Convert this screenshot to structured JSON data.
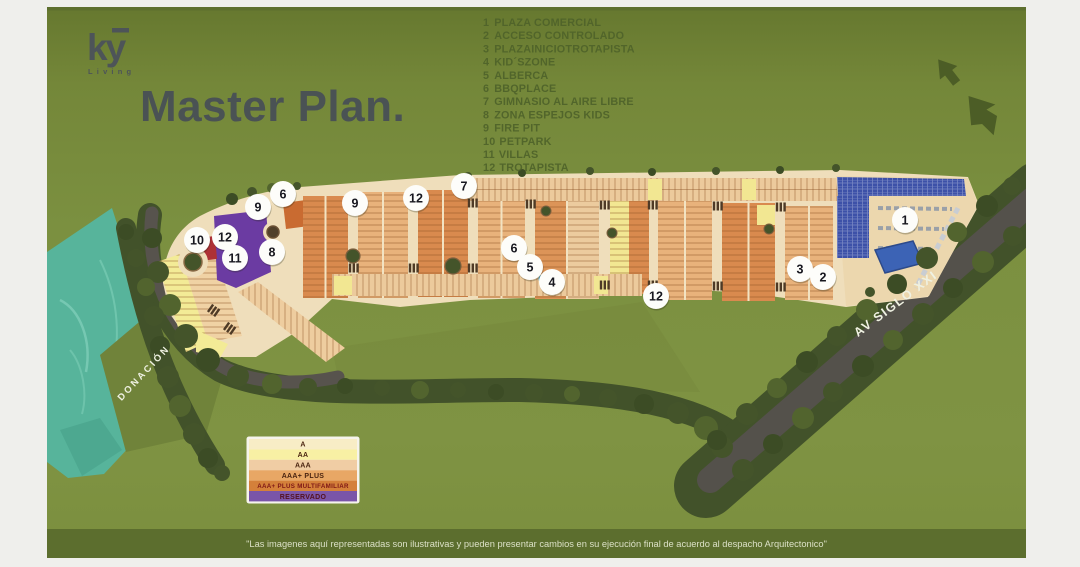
{
  "brand": {
    "name": "ky",
    "tagline": "Living"
  },
  "title": "Master Plan.",
  "amenities": {
    "items": [
      {
        "num": "1",
        "label": "PLAZA COMERCIAL"
      },
      {
        "num": "2",
        "label": "ACCESO CONTROLADO"
      },
      {
        "num": "3",
        "label": "PLAZAINICIOTROTAPISTA"
      },
      {
        "num": "4",
        "label": "KID´SZONE"
      },
      {
        "num": "5",
        "label": "ALBERCA"
      },
      {
        "num": "6",
        "label": "BBQPLACE"
      },
      {
        "num": "7",
        "label": "GIMNASIO AL AIRE LIBRE"
      },
      {
        "num": "8",
        "label": "ZONA ESPEJOS KIDS"
      },
      {
        "num": "9",
        "label": "FIRE PIT"
      },
      {
        "num": "10",
        "label": "PETPARK"
      },
      {
        "num": "11",
        "label": "VILLAS"
      },
      {
        "num": "12",
        "label": "TROTAPISTA"
      }
    ]
  },
  "map": {
    "road_label": "AV SIGLO XXI",
    "area_label": "DONACIÓN",
    "markers": [
      "9",
      "6",
      "10",
      "12",
      "11",
      "8",
      "9",
      "12",
      "7",
      "6",
      "5",
      "4",
      "12",
      "3",
      "2",
      "1"
    ]
  },
  "lot_legend": {
    "rows": [
      {
        "label": "A",
        "color": "#f8edc6",
        "text_color": "#4a2410"
      },
      {
        "label": "AA",
        "color": "#f8f0a4",
        "text_color": "#4a2410"
      },
      {
        "label": "AAA",
        "color": "#f0cda4",
        "text_color": "#4a2410"
      },
      {
        "label": "AAA+ PLUS",
        "color": "#e8a765",
        "text_color": "#4a2410"
      },
      {
        "label": "AAA+ PLUS MULTIFAMILIAR",
        "color": "#d4803a",
        "text_color": "#7e1616"
      },
      {
        "label": "RESERVADO",
        "color": "#7a55a8",
        "text_color": "#541220"
      }
    ]
  },
  "disclaimer": "\"Las imagenes aquí representadas son ilustrativas y pueden presentar cambios en su ejecución final de acuerdo al despacho Arquitectonico\""
}
